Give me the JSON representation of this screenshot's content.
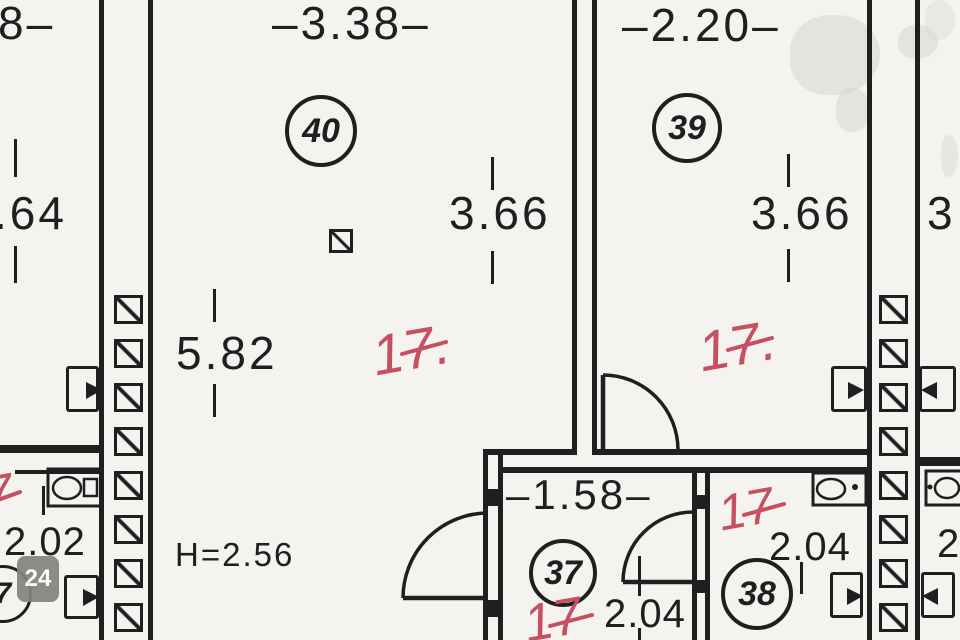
{
  "plan": {
    "dims": {
      "top_left_partial": "8–",
      "room40_width": "–3.38–",
      "room39_width": "–2.20–",
      "left_height_partial": ".64",
      "room40_height": "3.66",
      "room39_height": "3.66",
      "right_height_partial": "3",
      "room40_length": "5.82",
      "hall_width": "–1.58–",
      "hall_depth": "2.04",
      "room38_width": "2.04",
      "bath_width": "2.02",
      "right_width_partial": "2",
      "ceiling_height": "H=2.56"
    },
    "room_numbers": {
      "room40": "40",
      "room39": "39",
      "room37": "37",
      "room38": "38",
      "left_partial": "7"
    },
    "area_marks": {
      "room40": "17.",
      "room39": "17.",
      "room38": "17",
      "room37": "17",
      "left_partial": "7"
    },
    "watermark": "24",
    "colors": {
      "ink": "#1f1f1f",
      "red_mark": "#c64f60",
      "paper": "#f4f3f0",
      "watermark_bg": "#85837f"
    }
  }
}
